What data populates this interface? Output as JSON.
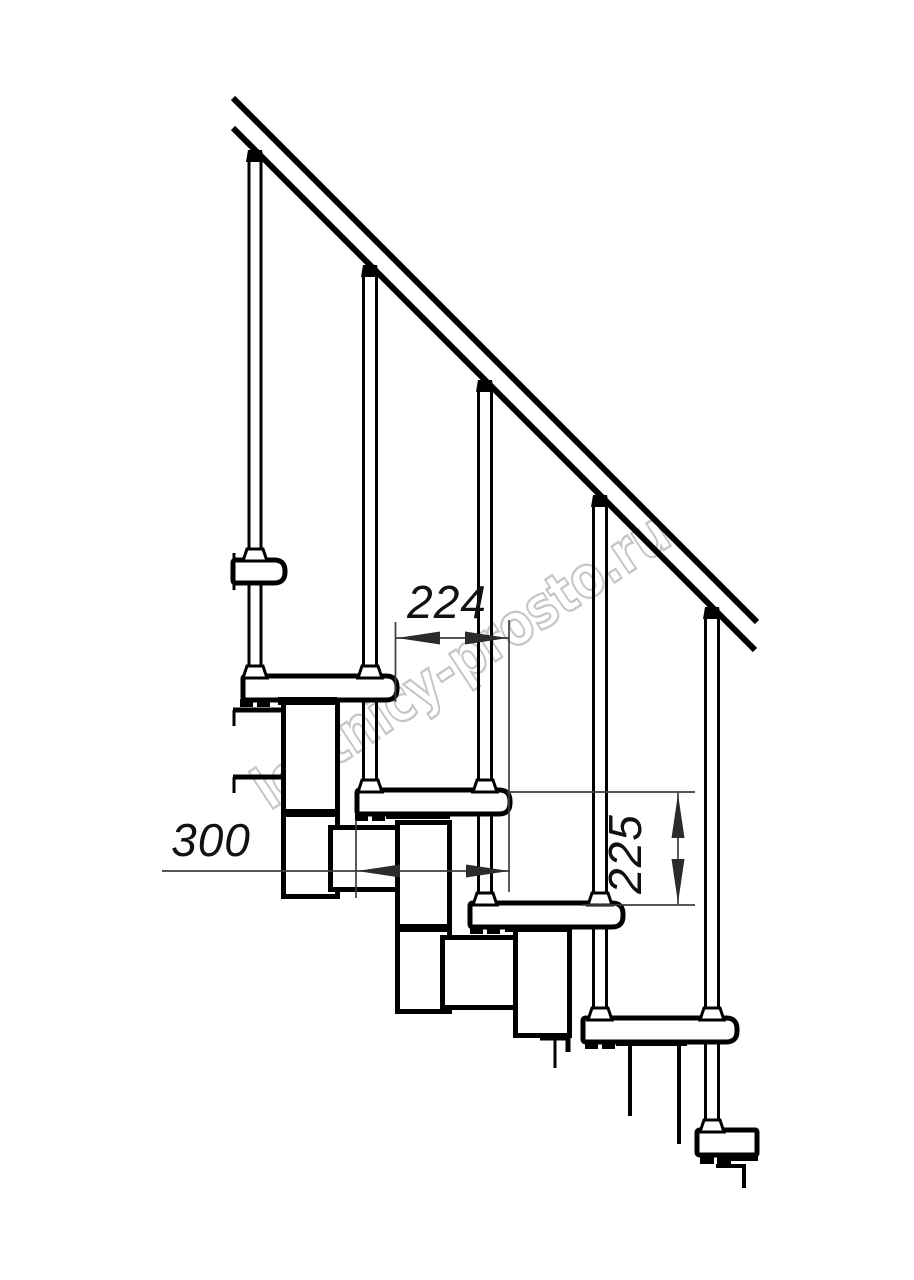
{
  "title": "Modular staircase side-view technical drawing",
  "watermark": {
    "text": "lestnicy-prosto.ru",
    "color": "#c5c5c5"
  },
  "dimensions": {
    "going": {
      "label": "224",
      "meaning": "horizontal step going between tread edges"
    },
    "tread_depth": {
      "label": "300",
      "meaning": "tread depth"
    },
    "rise": {
      "label": "225",
      "meaning": "step rise between tread tops"
    }
  },
  "colors": {
    "line": "#000000",
    "dimension_line": "#3d3d3d",
    "watermark": "#c5c5c5",
    "background": "#ffffff"
  }
}
